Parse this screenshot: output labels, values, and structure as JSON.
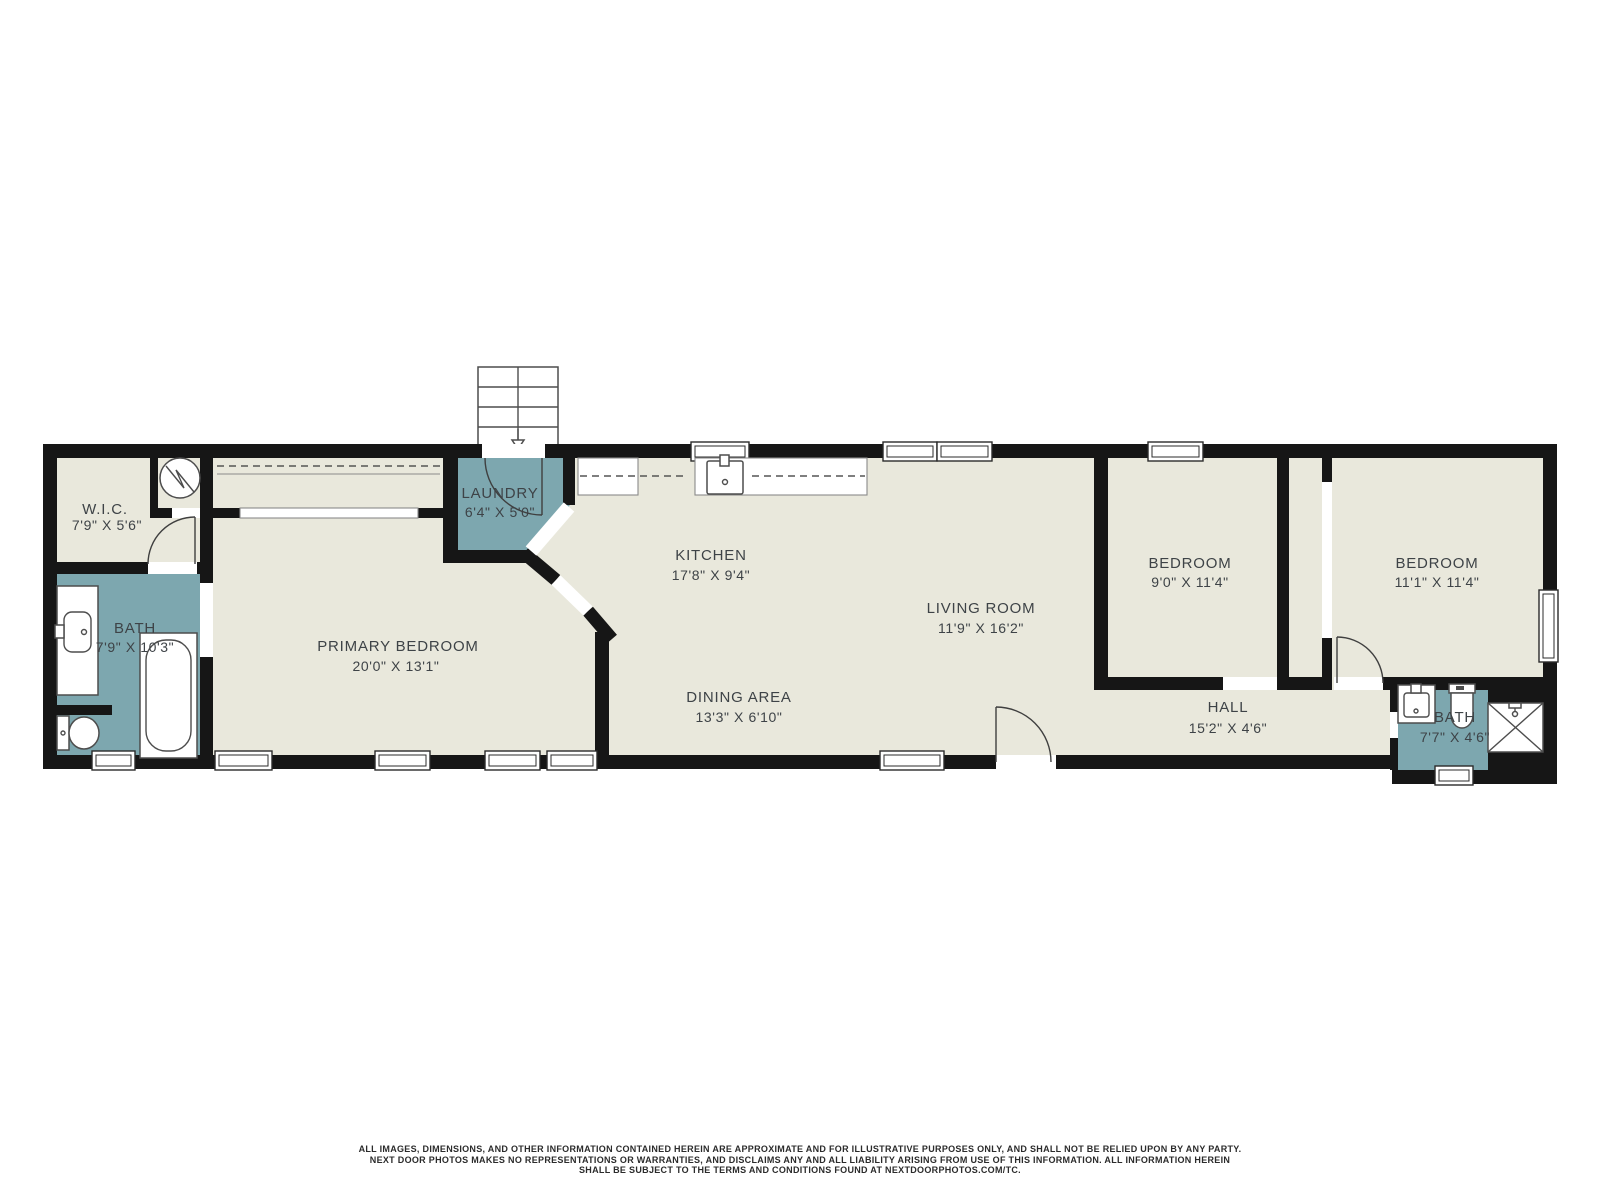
{
  "colors": {
    "floor": "#e9e8dc",
    "wet_room": "#7da7af",
    "wall": "#161616",
    "fixture_outline": "#4d4d4d",
    "label_text": "#3e4347",
    "background": "#ffffff"
  },
  "rooms": {
    "wic": {
      "name": "W.I.C.",
      "dims": "7'9\" X 5'6\""
    },
    "bath_left": {
      "name": "BATH",
      "dims": "7'9\" X 10'3\""
    },
    "primary_bedroom": {
      "name": "PRIMARY BEDROOM",
      "dims": "20'0\" X 13'1\""
    },
    "laundry": {
      "name": "LAUNDRY",
      "dims": "6'4\" X 5'0\""
    },
    "kitchen": {
      "name": "KITCHEN",
      "dims": "17'8\" X 9'4\""
    },
    "living_room": {
      "name": "LIVING ROOM",
      "dims": "11'9\" X 16'2\""
    },
    "dining_area": {
      "name": "DINING AREA",
      "dims": "13'3\" X 6'10\""
    },
    "bedroom_1": {
      "name": "BEDROOM",
      "dims": "9'0\" X 11'4\""
    },
    "bedroom_2": {
      "name": "BEDROOM",
      "dims": "11'1\" X 11'4\""
    },
    "hall": {
      "name": "HALL",
      "dims": "15'2\" X 4'6\""
    },
    "bath_right": {
      "name": "BATH",
      "dims": "7'7\" X 4'6\""
    }
  },
  "icons": {
    "stairs": "stairs-down-icon",
    "water_heater": "water-heater-icon",
    "bathtub": "bathtub-icon",
    "toilet": "toilet-icon",
    "sink": "sink-icon",
    "shower": "shower-icon"
  },
  "disclaimer": {
    "line1": "ALL IMAGES, DIMENSIONS, AND OTHER INFORMATION CONTAINED HEREIN ARE APPROXIMATE AND FOR ILLUSTRATIVE PURPOSES ONLY, AND SHALL NOT BE RELIED UPON BY ANY PARTY.",
    "line2": "NEXT DOOR PHOTOS MAKES NO REPRESENTATIONS OR WARRANTIES, AND DISCLAIMS ANY AND ALL LIABILITY ARISING FROM USE OF THIS INFORMATION. ALL INFORMATION HEREIN",
    "line3": "SHALL BE SUBJECT TO THE TERMS AND CONDITIONS FOUND AT NEXTDOORPHOTOS.COM/TC."
  }
}
